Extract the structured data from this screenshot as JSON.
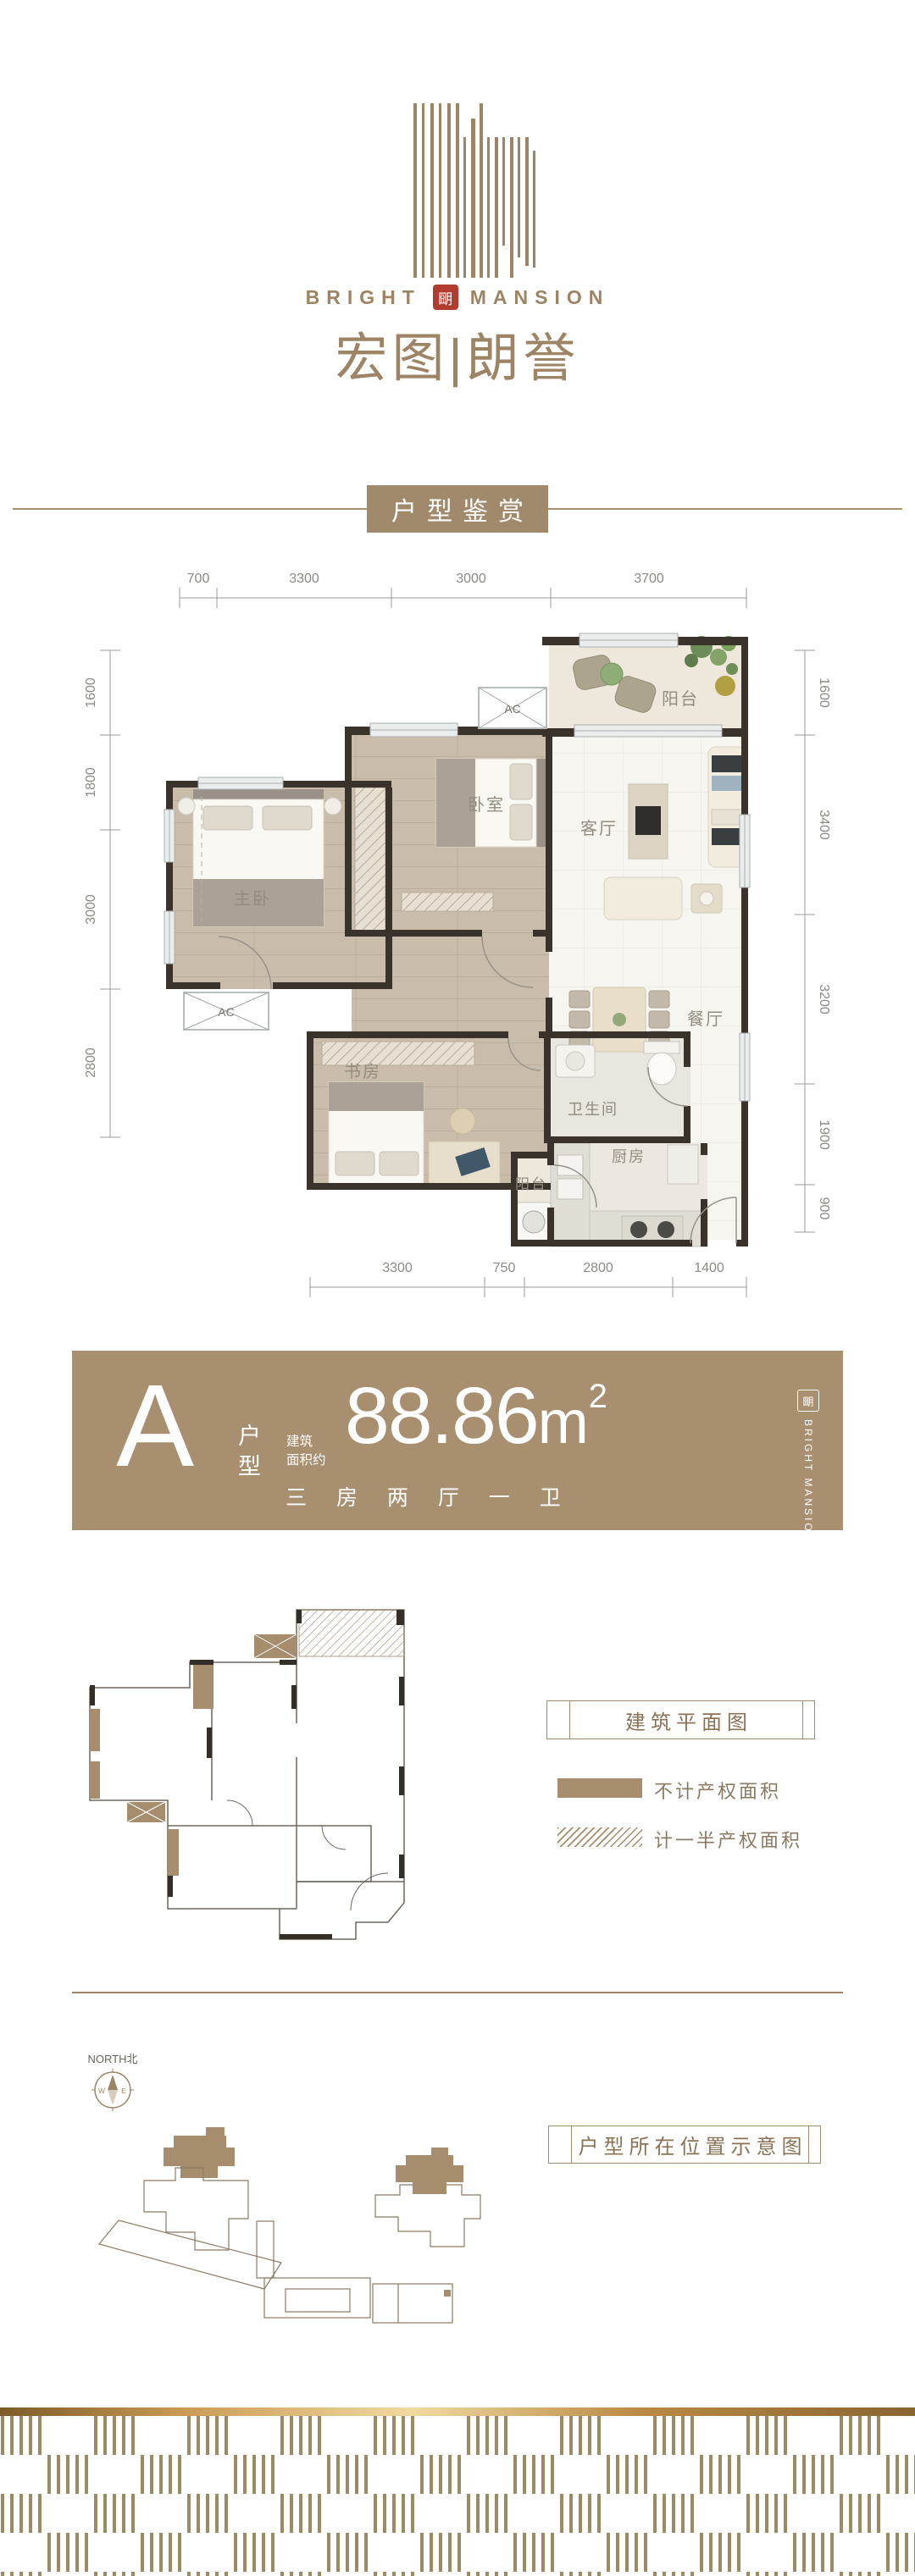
{
  "colors": {
    "brand": "#9C8465",
    "banner": "#A88F6F",
    "seal_red": "#B23C30",
    "wall": "#3A332B"
  },
  "logo": {
    "en_left": "BRIGHT",
    "en_right": "MANSION",
    "seal": "朙",
    "cn": "宏图|朗誉"
  },
  "section": {
    "title": "户型鉴赏"
  },
  "plan": {
    "ac": "AC",
    "rooms": {
      "balcony_top": "阳台",
      "living": "客厅",
      "bedroom": "卧室",
      "master": "主卧",
      "study": "书房",
      "bath": "卫生间",
      "kitchen": "厨房",
      "balcony_bottom": "阳台",
      "dining": "餐厅"
    },
    "dims_top": [
      "700",
      "3300",
      "3000",
      "3700"
    ],
    "dims_left": [
      "1600",
      "1800",
      "3000",
      "2800"
    ],
    "dims_right": [
      "1600",
      "3400",
      "3200",
      "1900",
      "900"
    ],
    "dims_bottom": [
      "3300",
      "750",
      "2800",
      "1400"
    ]
  },
  "banner": {
    "letter": "A",
    "type_char_1": "户",
    "type_char_2": "型",
    "area_label_line1": "建筑",
    "area_label_line2": "面积约",
    "area_value": "88.86",
    "area_unit": "m",
    "area_sup": "2",
    "layout": "三 房 两 厅 一 卫",
    "seal": "朙",
    "logo_vertical": "BRIGHT MANSION"
  },
  "building_plan": {
    "title": "建筑平面图",
    "legend_solid_label": "不计产权面积",
    "legend_half_label": "计一半产权面积"
  },
  "location": {
    "north_label": "NORTH北",
    "west": "W",
    "east": "E",
    "title": "户型所在位置示意图"
  }
}
